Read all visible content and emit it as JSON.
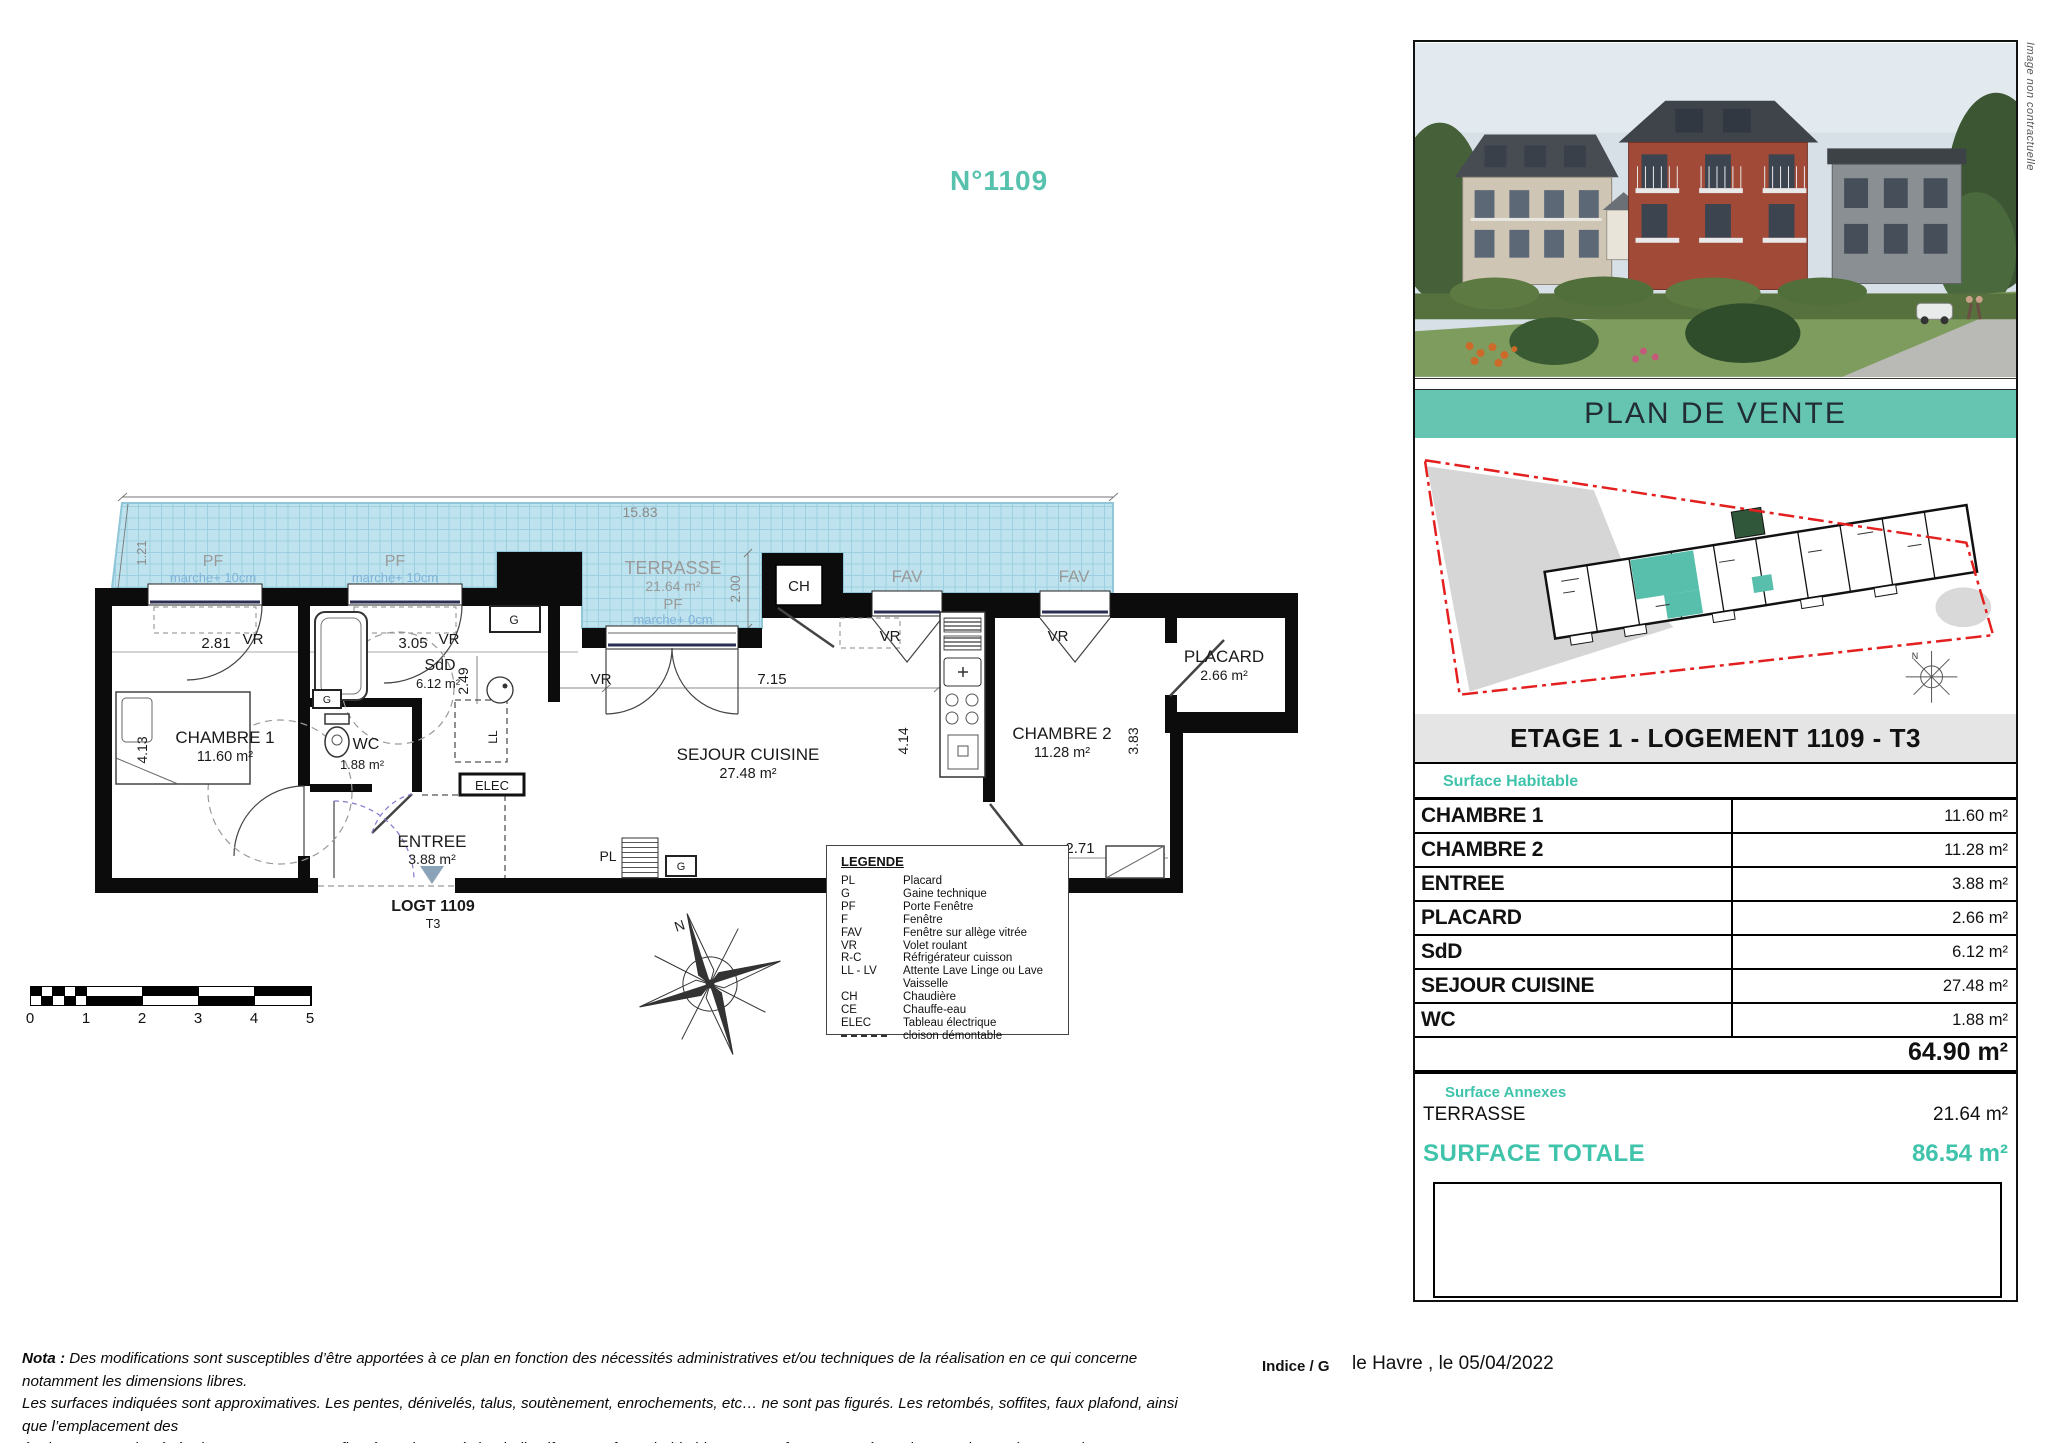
{
  "page": {
    "title_number": "N°1109"
  },
  "photo": {
    "caption_vertical": "Image non contractuelle"
  },
  "band": {
    "title": "PLAN DE VENTE"
  },
  "panel": {
    "header": "ETAGE 1 - LOGEMENT 1109 - T3",
    "surface_habitable_label": "Surface Habitable",
    "rows": [
      {
        "label": "CHAMBRE 1",
        "value": "11.60 m²"
      },
      {
        "label": "CHAMBRE 2",
        "value": "11.28 m²"
      },
      {
        "label": "ENTREE",
        "value": "3.88 m²"
      },
      {
        "label": "PLACARD",
        "value": "2.66 m²"
      },
      {
        "label": "SdD",
        "value": "6.12 m²"
      },
      {
        "label": "SEJOUR CUISINE",
        "value": "27.48 m²"
      },
      {
        "label": "WC",
        "value": "1.88 m²"
      }
    ],
    "total_value": "64.90 m²",
    "surface_annexes_label": "Surface Annexes",
    "annex_label": "TERRASSE",
    "annex_value": "21.64 m²",
    "surface_totale_label": "SURFACE TOTALE",
    "surface_totale_value": "86.54 m²"
  },
  "plan": {
    "logt": "LOGT 1109",
    "type": "T3",
    "labels": {
      "chambre1": "CHAMBRE 1",
      "chambre1_area": "11.60 m²",
      "chambre2": "CHAMBRE 2",
      "chambre2_area": "11.28 m²",
      "sejour": "SEJOUR CUISINE",
      "sejour_area": "27.48 m²",
      "entree": "ENTREE",
      "entree_area": "3.88 m²",
      "wc": "WC",
      "wc_area": "1.88 m²",
      "sdd": "SdD",
      "sdd_area": "6.12 m²",
      "placard": "PLACARD",
      "placard_area": "2.66 m²",
      "terrasse": "TERRASSE",
      "terrasse_area": "21.64 m²",
      "pf": "PF",
      "marche10": "marche+ 10cm",
      "marche0": "marche+ 0cm",
      "fav": "FAV",
      "vr": "VR",
      "ch": "CH",
      "g": "G",
      "pl": "PL",
      "ll": "LL",
      "elec": "ELEC",
      "dim_1583": "15.83",
      "dim_121": "1.21",
      "dim_200": "2.00",
      "dim_281": "2.81",
      "dim_305": "3.05",
      "dim_249": "2.49",
      "dim_413": "4.13",
      "dim_715": "7.15",
      "dim_414": "4.14",
      "dim_383": "3.83",
      "dim_271": "2.71"
    }
  },
  "legend": {
    "title": "LEGENDE",
    "items": [
      {
        "abbr": "PL",
        "desc": "Placard"
      },
      {
        "abbr": "G",
        "desc": "Gaine technique"
      },
      {
        "abbr": "PF",
        "desc": "Porte Fenêtre"
      },
      {
        "abbr": "F",
        "desc": "Fenêtre"
      },
      {
        "abbr": "FAV",
        "desc": "Fenêtre sur allège vitrée"
      },
      {
        "abbr": "VR",
        "desc": "Volet roulant"
      },
      {
        "abbr": "R-C",
        "desc": "Réfrigérateur cuisson"
      },
      {
        "abbr": "LL - LV",
        "desc": "Attente Lave Linge ou Lave Vaisselle"
      },
      {
        "abbr": "CH",
        "desc": "Chaudière"
      },
      {
        "abbr": "CE",
        "desc": "Chauffe-eau"
      },
      {
        "abbr": "ELEC",
        "desc": "Tableau électrique"
      },
      {
        "abbr": "",
        "desc": "cloison démontable"
      }
    ]
  },
  "scalebar": {
    "labels": [
      "0",
      "1",
      "2",
      "3",
      "4",
      "5"
    ]
  },
  "compass": {
    "north": "N"
  },
  "footer": {
    "nota_prefix": "Nota :",
    "line1": " Des modifications sont susceptibles d’être apportées à ce plan en fonction des nécessités administratives et/ou techniques de la réalisation en ce qui concerne notamment les dimensions libres.",
    "line2": "Les surfaces indiquées sont approximatives. Les pentes, dénivelés, talus, soutènement, enrochements, etc… ne sont pas figurés. Les retombés, soffites, faux plafond, ainsi que l’emplacement des",
    "line3": "équipements ou la végétation ne sont pas tous figurés ou le sont à titre indicatif. Les surfaces habitables sont conformes au Décret du 23 mai 1997 (art. 111-2)",
    "indice": "Indice / G",
    "place_date": "le Havre , le 05/04/2022"
  }
}
